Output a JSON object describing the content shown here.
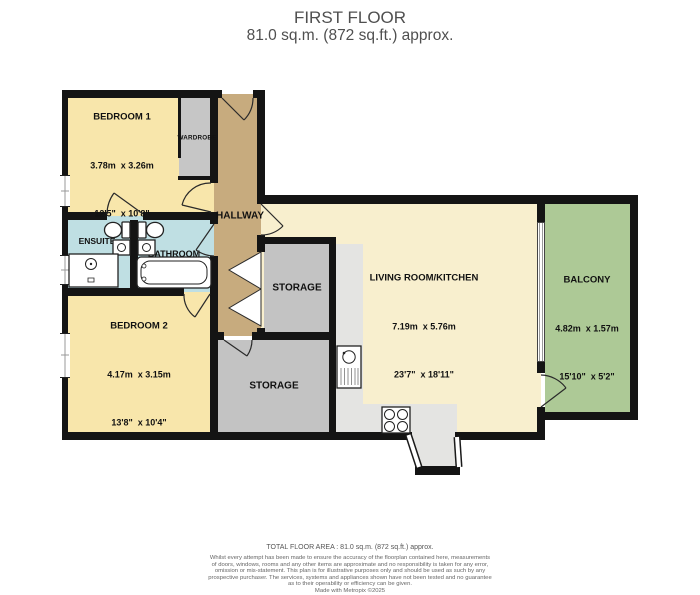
{
  "title": {
    "line1": "FIRST FLOOR",
    "line2": "81.0 sq.m. (872 sq.ft.) approx."
  },
  "rooms": {
    "bedroom1": {
      "name": "BEDROOM 1",
      "metric": "3.78m  x 3.26m",
      "imperial": "12'5\"  x 10'8\""
    },
    "bedroom2": {
      "name": "BEDROOM 2",
      "metric": "4.17m  x 3.15m",
      "imperial": "13'8\"  x 10'4\""
    },
    "living": {
      "name": "LIVING ROOM/KITCHEN",
      "metric": "7.19m  x 5.76m",
      "imperial": "23'7\"  x 18'11\""
    },
    "balcony": {
      "name": "BALCONY",
      "metric": "4.82m  x 1.57m",
      "imperial": "15'10\"  x 5'2\""
    },
    "hallway": {
      "name": "HALLWAY"
    },
    "ensuite": {
      "name": "ENSUITE"
    },
    "bathroom": {
      "name": "BATHROOM"
    },
    "wardrobe": {
      "name": "WARDROBE"
    },
    "storage_upper": {
      "name": "STORAGE"
    },
    "storage_lower": {
      "name": "STORAGE"
    }
  },
  "footer": {
    "total_area": "TOTAL FLOOR AREA : 81.0 sq.m. (872 sq.ft.) approx.",
    "disclaimer_line1": "Whilst every attempt has been made to ensure the accuracy of the floorplan contained here, measurements",
    "disclaimer_line2": "of doors, windows, rooms and any other items are approximate and no responsibility is taken for any error,",
    "disclaimer_line3": "omission or mis-statement. This plan is for illustrative purposes only and should be used as such by any",
    "disclaimer_line4": "prospective purchaser. The services, systems and appliances shown have not been tested and no guarantee",
    "disclaimer_line5": "as to their operability or efficiency can be given.",
    "credit": "Made with Metropix ©2025"
  },
  "colors": {
    "walls": "#141414",
    "bedroom_fill": "#f8e6ab",
    "living_fill": "#f8efce",
    "hallway_fill": "#c7ab7e",
    "bathroom_fill": "#bfdfe3",
    "storage_fill": "#c3c3c3",
    "kitchen_floor": "#e4e4e2",
    "balcony_fill": "#adc996",
    "title_text": "#4f4f4f"
  }
}
